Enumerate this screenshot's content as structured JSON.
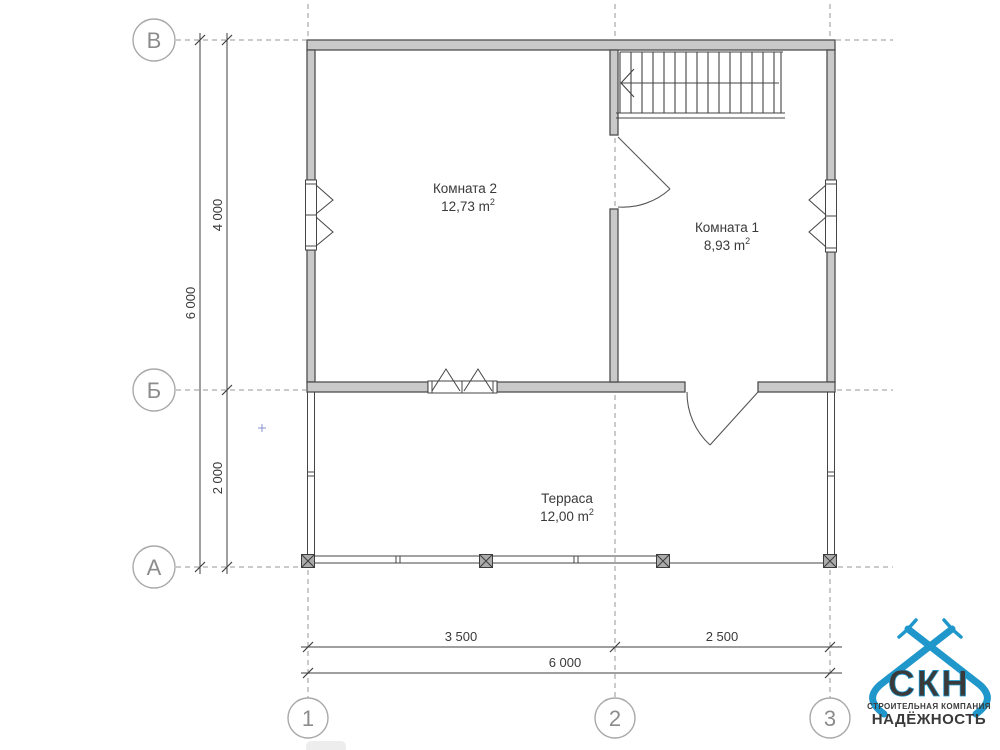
{
  "plan": {
    "axis_rows": [
      "В",
      "Б",
      "А"
    ],
    "axis_cols": [
      "1",
      "2",
      "3"
    ],
    "dims": {
      "left_total": "6 000",
      "left_upper": "4 000",
      "left_lower": "2 000",
      "bottom_left": "3 500",
      "bottom_right": "2 500",
      "bottom_total": "6 000"
    },
    "rooms": [
      {
        "name": "Комната 2",
        "area": "12,73 m",
        "area_sup": "2"
      },
      {
        "name": "Комната 1",
        "area": "8,93 m",
        "area_sup": "2"
      },
      {
        "name": "Терраса",
        "area": "12,00 m",
        "area_sup": "2"
      }
    ]
  },
  "logo": {
    "abbr": "СКН",
    "tagline": "СТРОИТЕЛЬНАЯ КОМПАНИЯ",
    "name": "НАДЁЖНОСТЬ"
  },
  "colors": {
    "wall_fill": "#c9c9c9",
    "wall_stroke": "#4f4f4f",
    "line": "#444444",
    "grid_dash": "#979797",
    "axis_text": "#8c8c8c",
    "logo_blue": "#1f97cb",
    "logo_green": "#a4c233"
  }
}
